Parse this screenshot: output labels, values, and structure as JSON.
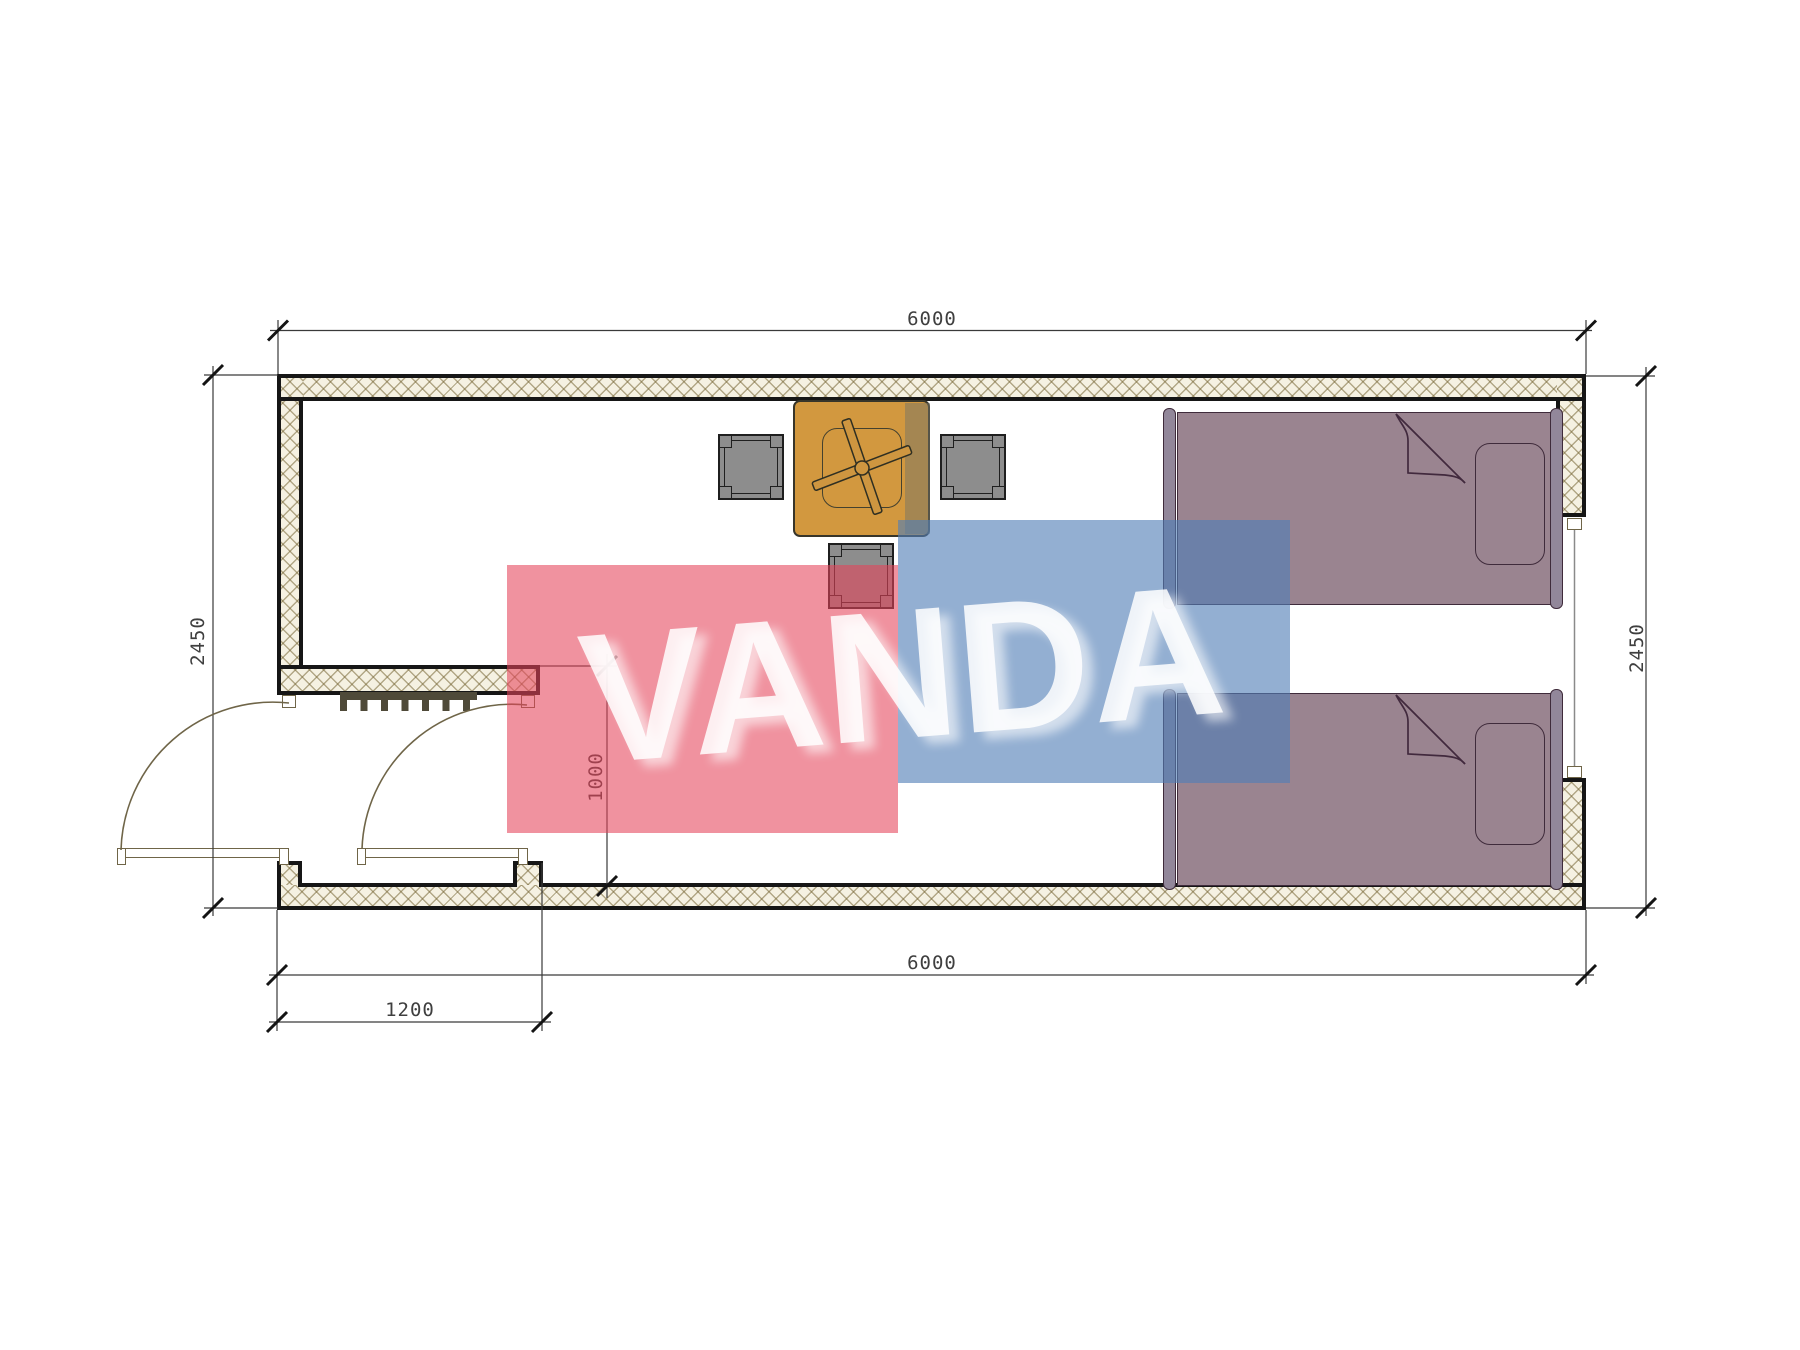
{
  "plan": {
    "dims": {
      "top_width": "6000",
      "bottom_width": "6000",
      "left_height": "2450",
      "right_height": "2450",
      "entry_opening": "1200",
      "entry_depth": "1000"
    },
    "watermark": {
      "text": "VANDA",
      "red": "#E5435A",
      "blue": "#517EB6"
    },
    "colors": {
      "wall_fill": "#F5F1E2",
      "wall_line": "#161616",
      "bed": "#9A8490",
      "bed_outline": "#3F2B3B",
      "table": "#D2983F",
      "stool": "#8D8D8D",
      "door_line": "#6F6548"
    }
  }
}
